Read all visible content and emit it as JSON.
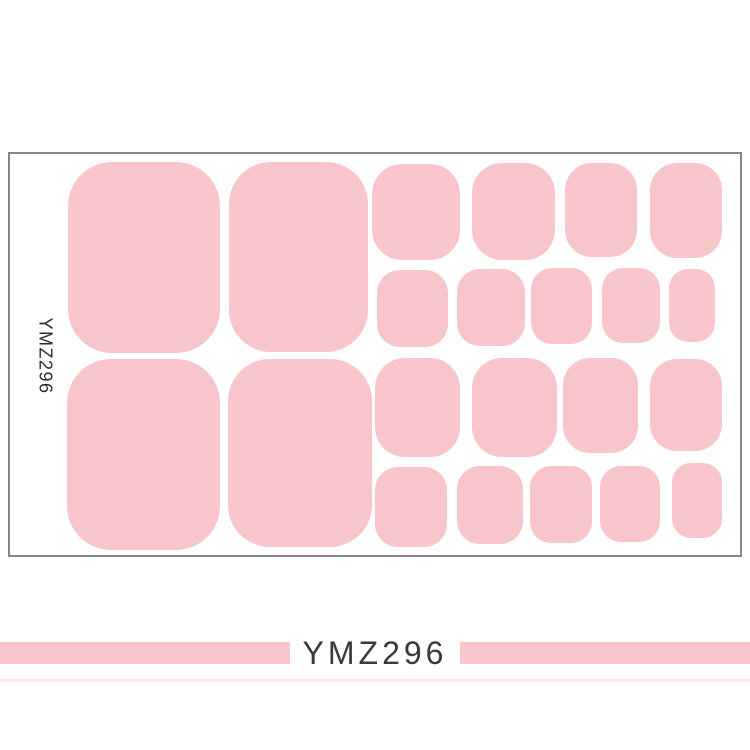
{
  "labels": {
    "sheet_vertical_label": "YMZ296",
    "banner_text": "YMZ296"
  },
  "colors": {
    "page_background": "#ffffff",
    "sticker_pink": "#f8c6ca",
    "sheet_border_gray": "#868686",
    "label_text_dark": "#2b2b2b",
    "banner_text_dark": "#3a3a3a"
  },
  "sheet": {
    "x": 8,
    "y": 152,
    "width": 734,
    "height": 405
  },
  "stickers": [
    {
      "name": "big-toe-1",
      "x": 68,
      "y": 162,
      "w": 152,
      "h": 191,
      "r": 44
    },
    {
      "name": "big-toe-2",
      "x": 229,
      "y": 162,
      "w": 139,
      "h": 190,
      "r": 42
    },
    {
      "name": "big-toe-3",
      "x": 67,
      "y": 359,
      "w": 153,
      "h": 191,
      "r": 44
    },
    {
      "name": "big-toe-4",
      "x": 228,
      "y": 359,
      "w": 144,
      "h": 188,
      "r": 42
    },
    {
      "name": "medium-a1",
      "x": 372,
      "y": 164,
      "w": 88,
      "h": 96,
      "r": 30
    },
    {
      "name": "medium-a2",
      "x": 472,
      "y": 163,
      "w": 83,
      "h": 97,
      "r": 30
    },
    {
      "name": "medium-a3",
      "x": 565,
      "y": 163,
      "w": 72,
      "h": 94,
      "r": 27
    },
    {
      "name": "medium-a4",
      "x": 650,
      "y": 163,
      "w": 72,
      "h": 95,
      "r": 27
    },
    {
      "name": "small-b1",
      "x": 377,
      "y": 270,
      "w": 71,
      "h": 77,
      "r": 23
    },
    {
      "name": "small-b2",
      "x": 457,
      "y": 269,
      "w": 68,
      "h": 77,
      "r": 23
    },
    {
      "name": "small-b3",
      "x": 531,
      "y": 268,
      "w": 61,
      "h": 76,
      "r": 21
    },
    {
      "name": "small-b4",
      "x": 602,
      "y": 268,
      "w": 58,
      "h": 75,
      "r": 21
    },
    {
      "name": "small-b5",
      "x": 669,
      "y": 269,
      "w": 46,
      "h": 73,
      "r": 19
    },
    {
      "name": "medium-c1",
      "x": 375,
      "y": 358,
      "w": 85,
      "h": 99,
      "r": 30
    },
    {
      "name": "medium-c2",
      "x": 472,
      "y": 358,
      "w": 85,
      "h": 99,
      "r": 30
    },
    {
      "name": "medium-c3",
      "x": 563,
      "y": 358,
      "w": 75,
      "h": 95,
      "r": 27
    },
    {
      "name": "medium-c4",
      "x": 650,
      "y": 359,
      "w": 72,
      "h": 92,
      "r": 27
    },
    {
      "name": "small-d1",
      "x": 375,
      "y": 467,
      "w": 72,
      "h": 80,
      "r": 23
    },
    {
      "name": "small-d2",
      "x": 457,
      "y": 466,
      "w": 66,
      "h": 78,
      "r": 23
    },
    {
      "name": "small-d3",
      "x": 530,
      "y": 466,
      "w": 62,
      "h": 77,
      "r": 21
    },
    {
      "name": "small-d4",
      "x": 600,
      "y": 466,
      "w": 60,
      "h": 76,
      "r": 21
    },
    {
      "name": "small-d5",
      "x": 672,
      "y": 463,
      "w": 50,
      "h": 75,
      "r": 19
    }
  ]
}
